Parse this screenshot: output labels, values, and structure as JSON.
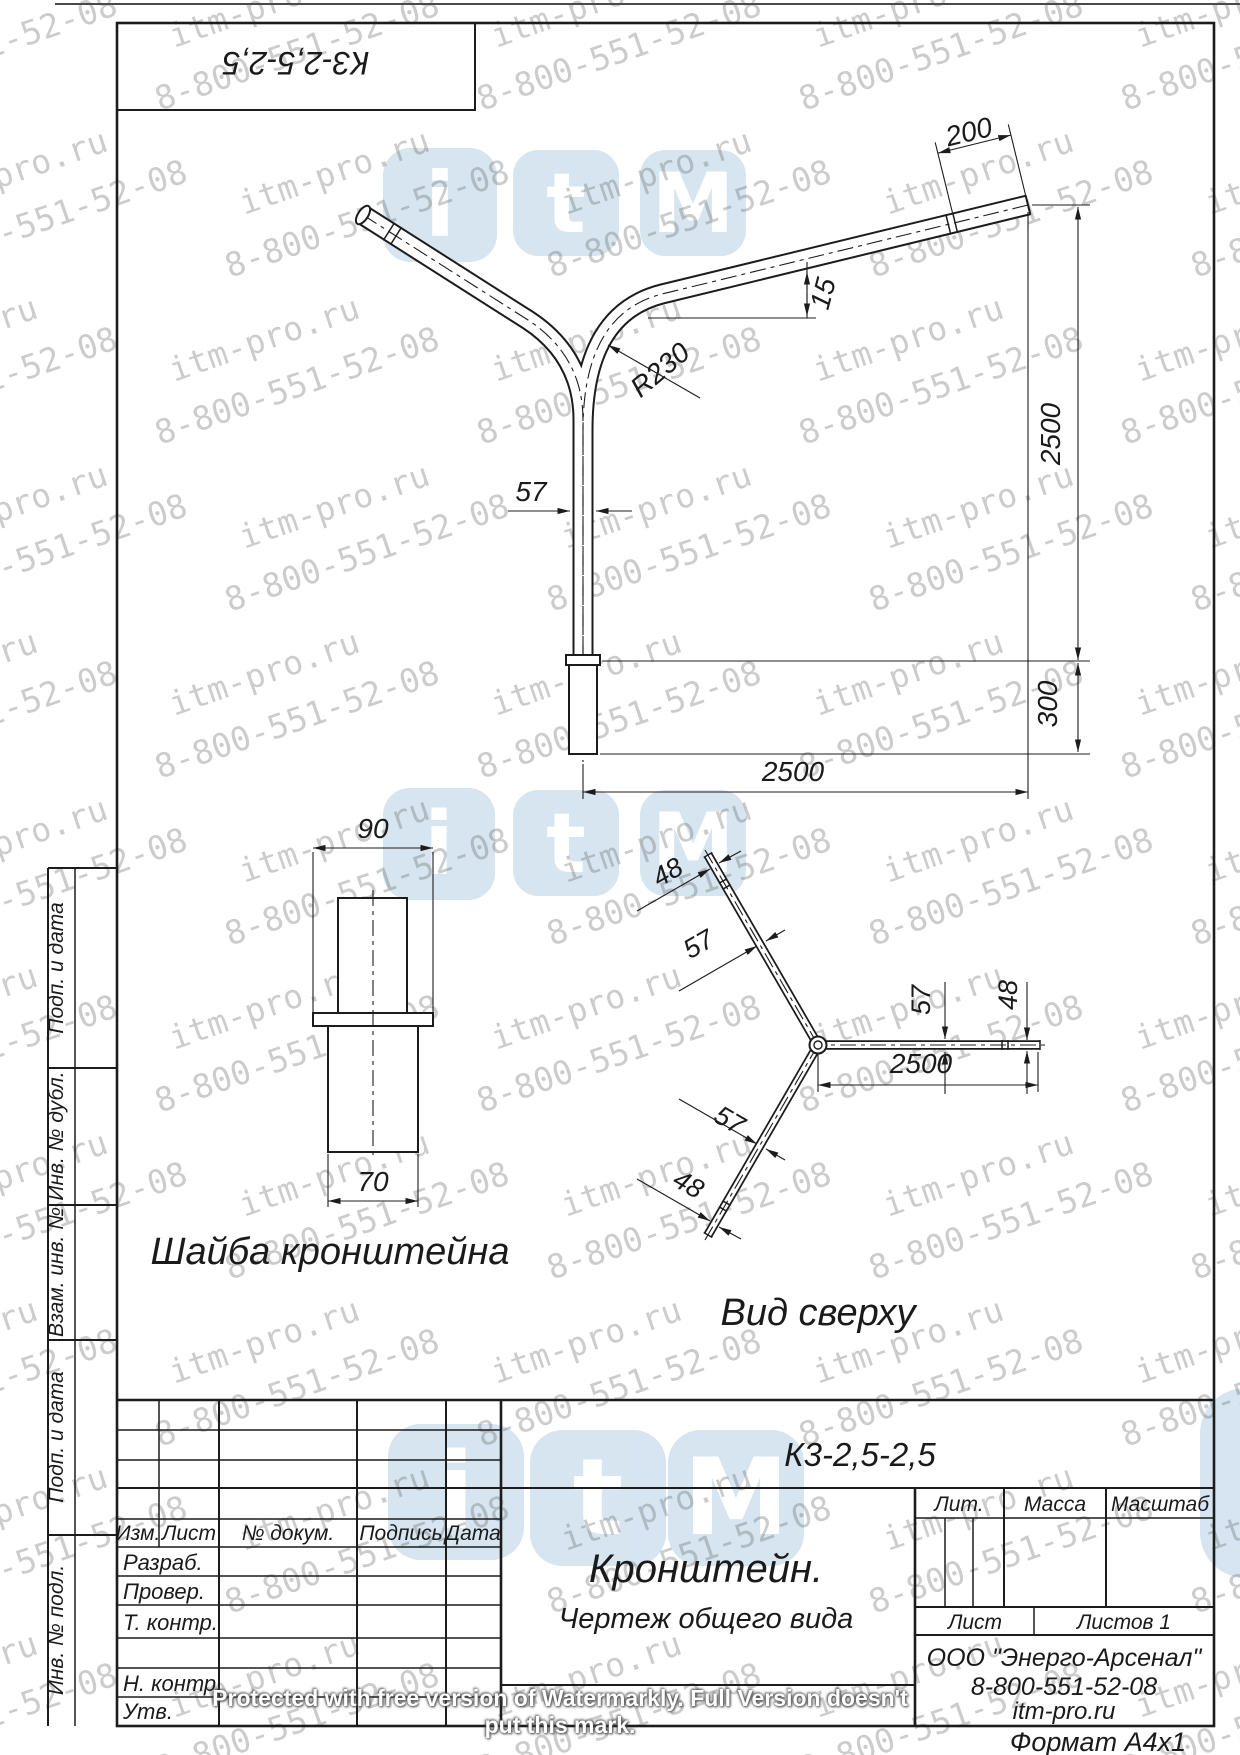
{
  "stamp": {
    "designation_rotated": "К3-2,5-2,5"
  },
  "main_view": {
    "dims": {
      "d200": "200",
      "d15": "15",
      "r230": "R230",
      "d57": "57",
      "v2500": "2500",
      "v300": "300",
      "h2500": "2500"
    }
  },
  "washer_view": {
    "title": "Шайба кронштейна",
    "dims": {
      "d90": "90",
      "d70": "70"
    }
  },
  "top_view": {
    "title": "Вид сверху",
    "dims": {
      "tip_upper_48": "48",
      "mid_upper_57": "57",
      "mid_lower_57": "57",
      "tip_lower_48": "48",
      "right_57": "57",
      "right_48": "48",
      "length_2500": "2500"
    }
  },
  "title_block": {
    "designation": "К3-2,5-2,5",
    "name": "Кронштейн.",
    "subtitle": "Чертеж общего вида",
    "headers": {
      "izm": "Изм.",
      "list": "Лист",
      "ndokum": "№ докум.",
      "podpis": "Подпись",
      "data": "Дата",
      "lit": "Лит.",
      "massa": "Масса",
      "masshtab": "Масштаб",
      "list2": "Лист",
      "listov": "Листов 1"
    },
    "rows": {
      "razrab": "Разраб.",
      "prover": "Провер.",
      "tkontr": "Т. контр.",
      "nkontr": "Н. контр.",
      "utv": "Утв."
    },
    "company": [
      "ООО \"Энерго-Арсенал\"",
      "8-800-551-52-08",
      "itm-pro.ru"
    ],
    "format": "Формат  А4х1"
  },
  "side_labels": [
    "Подп. и дата",
    "Инв. № дубл.",
    "Взам. инв. №",
    "Подп. и дата",
    "Инв. № подл."
  ],
  "watermarks": {
    "line1": "itm-pro.ru",
    "line2": "8-800-551-52-08",
    "protected": "Protected with free version of Watermarkly. Full Version doesn't put this mark.",
    "logo_letters": [
      "i",
      "t",
      "M"
    ],
    "logo_color": "#cfe1ee"
  }
}
